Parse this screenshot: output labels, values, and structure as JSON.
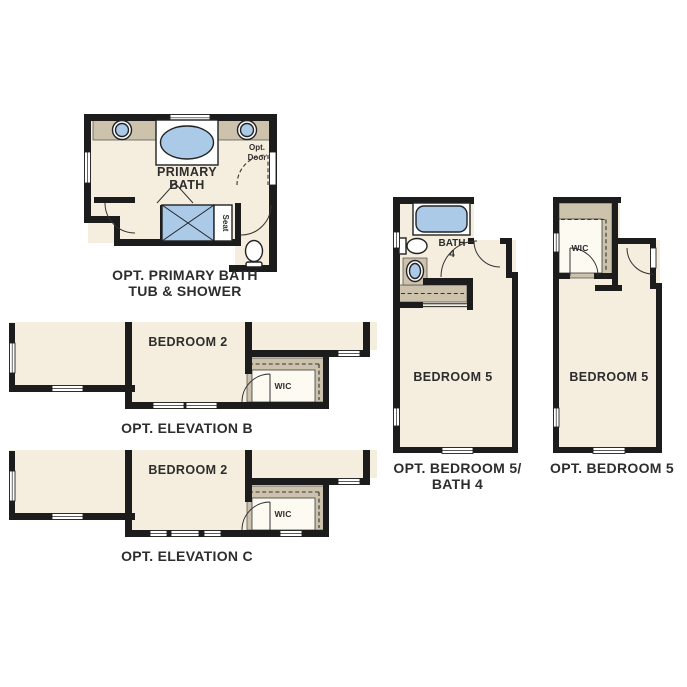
{
  "colors": {
    "background": "#ffffff",
    "wall": "#1c1c1c",
    "floor": "#f5eede",
    "shelf_counter": "#cdc2ac",
    "fixture_blue": "#aacae8",
    "text": "#2d2d2d"
  },
  "plans": {
    "primary_bath": {
      "title_line1": "OPT. PRIMARY BATH",
      "title_line2": "TUB & SHOWER",
      "room_label_line1": "PRIMARY",
      "room_label_line2": "BATH",
      "opt_door_line1": "Opt.",
      "opt_door_line2": "Door",
      "seat_label": "Seat"
    },
    "elevation_b": {
      "title": "OPT. ELEVATION B",
      "bedroom_label": "BEDROOM 2",
      "wic_label": "WIC"
    },
    "elevation_c": {
      "title": "OPT. ELEVATION C",
      "bedroom_label": "BEDROOM 2",
      "wic_label": "WIC"
    },
    "bedroom5_bath4": {
      "title_line1": "OPT. BEDROOM 5/",
      "title_line2": "BATH 4",
      "bath_label_line1": "BATH",
      "bath_label_line2": "4",
      "bedroom_label": "BEDROOM 5"
    },
    "bedroom5": {
      "title": "OPT. BEDROOM 5",
      "bedroom_label": "BEDROOM 5",
      "wic_label": "WIC"
    }
  }
}
